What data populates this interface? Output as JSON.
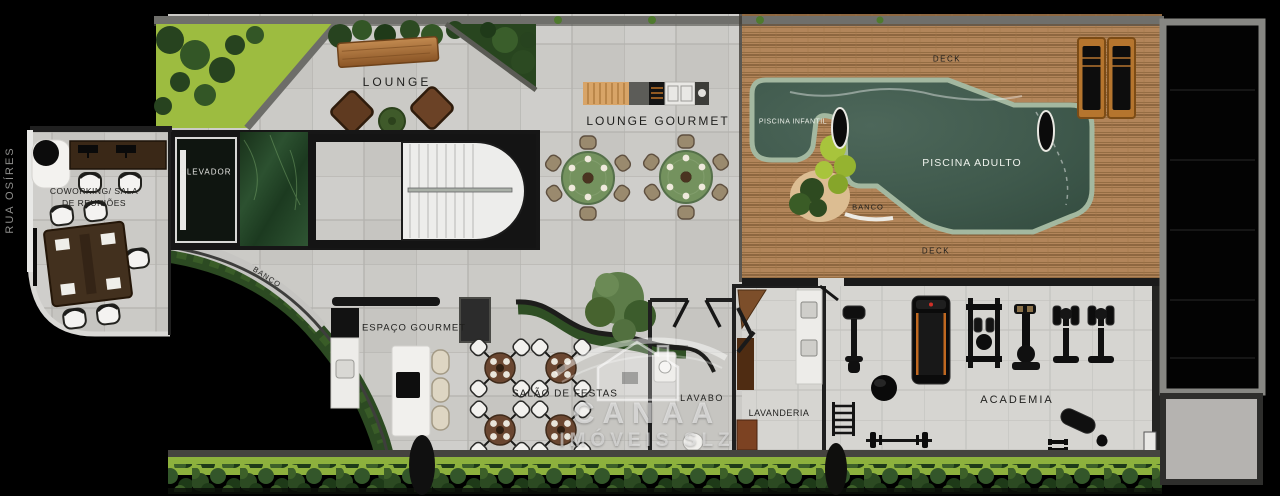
{
  "street": {
    "name": "RUA OSÍRES"
  },
  "rooms": {
    "lounge": {
      "label": "LOUNGE"
    },
    "lounge_gourmet": {
      "label": "LOUNGE GOURMET"
    },
    "elevator": {
      "label": "ELEVADOR"
    },
    "coworking": {
      "label_line1": "COWORKING/ SALA",
      "label_line2": "DE REUNIÕES"
    },
    "espaco_gourmet": {
      "label": "ESPAÇO GOURMET"
    },
    "salao_de_festas": {
      "label": "SALÃO DE FESTAS"
    },
    "lavabo": {
      "label": "LAVABO"
    },
    "lavanderia": {
      "label": "LAVANDERIA"
    },
    "academia": {
      "label": "ACADEMIA"
    }
  },
  "pool_area": {
    "deck_label_top": "DECK",
    "deck_label_bottom": "DECK",
    "piscina_infantil": "PISCINA INFANTIL",
    "piscina_adulto": "PISCINA ADULTO",
    "banco": "BANCO"
  },
  "garden": {
    "banco_path_label": "BANCO"
  },
  "watermark": {
    "brand": "CANAA",
    "subtitle": "IMÓVEIS SLZ",
    "icon": "house-icon"
  },
  "colors": {
    "background": "#000000",
    "floor_tile": "#cbcac6",
    "gym_tile": "#d6d5d1",
    "deck_wood": "#b2855a",
    "pool_water": "#3f594c",
    "pool_coping": "#a3b8a0",
    "lawn": "#9dbc40",
    "hedge": "#2c4a22",
    "wall_dark": "#1a1a1a",
    "wall_concrete": "#6f6f6b",
    "marble_green": "#2c5130"
  }
}
